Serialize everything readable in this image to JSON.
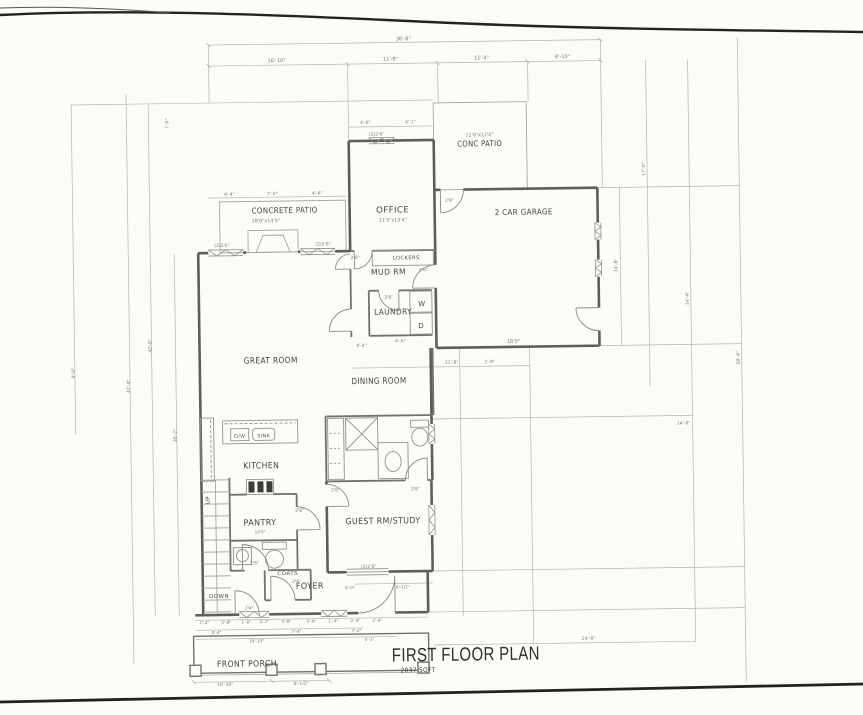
{
  "drawing": {
    "title": "FIRST FLOOR PLAN",
    "area": "2037 SQFT",
    "rooms": [
      "GREAT ROOM",
      "KITCHEN",
      "DINING ROOM",
      "OFFICE",
      "MUD RM",
      "LAUNDRY",
      "PANTRY",
      "FOYER",
      "GUEST RM/STUDY",
      "2 CAR GARAGE",
      "CONC PATIO",
      "CONCRETE PATIO",
      "FRONT PORCH"
    ]
  },
  "colors": {
    "paper": "#fcfbf8",
    "wall": "#5a5f59",
    "interior_wall": "#6e746c",
    "fixture_line": "#8d938b",
    "faint_line": "#b2b7ab",
    "room_text": "#42463e",
    "dim_text": "#757a6e",
    "scan_edge": "#23231d"
  },
  "labels": [
    {
      "id": "title-main",
      "text": "FIRST FLOOR PLAN",
      "x": 462,
      "y": 661,
      "fs": 19,
      "w": 148,
      "cls": "title"
    },
    {
      "id": "title-area",
      "text": "2037 SQFT",
      "x": 414,
      "y": 672,
      "fs": 6.5,
      "w": 35,
      "cls": "subtitle"
    },
    {
      "id": "room-conc-patio",
      "text": "CONC PATIO",
      "x": 483,
      "y": 147,
      "fs": 8,
      "w": 45
    },
    {
      "id": "dim-conc-patio",
      "text": "11'0\"x12'0\"",
      "x": 483,
      "y": 137,
      "fs": 4.8,
      "cls": "dim"
    },
    {
      "id": "room-garage",
      "text": "2 CAR GARAGE",
      "x": 526,
      "y": 216,
      "fs": 8,
      "w": 58
    },
    {
      "id": "room-office",
      "text": "OFFICE",
      "x": 395,
      "y": 212,
      "fs": 8.5,
      "w": 33
    },
    {
      "id": "dim-office",
      "text": "11'3\"x13'4\"",
      "x": 395,
      "y": 221,
      "fs": 4.8,
      "cls": "dim"
    },
    {
      "id": "room-concrete-patio",
      "text": "CONCRETE PATIO",
      "x": 287,
      "y": 211,
      "fs": 8,
      "w": 66
    },
    {
      "id": "dim-concrete-patio",
      "text": "18'0\"x14'0\"",
      "x": 268,
      "y": 220,
      "fs": 4.8,
      "cls": "dim"
    },
    {
      "id": "room-mud",
      "text": "MUD RM",
      "x": 390,
      "y": 274,
      "fs": 8,
      "w": 35
    },
    {
      "id": "fixture-lockers",
      "text": "LOCKERS",
      "x": 408,
      "y": 259,
      "fs": 5,
      "w": 27,
      "cls": "fix"
    },
    {
      "id": "room-laundry",
      "text": "LAUNDRY",
      "x": 394,
      "y": 314,
      "fs": 8,
      "w": 38
    },
    {
      "id": "fixture-washer",
      "text": "W",
      "x": 423,
      "y": 306,
      "fs": 7,
      "cls": "fix"
    },
    {
      "id": "fixture-dryer",
      "text": "D",
      "x": 422,
      "y": 328,
      "fs": 7,
      "cls": "fix"
    },
    {
      "id": "room-dining",
      "text": "DINING ROOM",
      "x": 379,
      "y": 383,
      "fs": 8.5,
      "w": 55
    },
    {
      "id": "room-great",
      "text": "GREAT ROOM",
      "x": 271,
      "y": 361,
      "fs": 8.5,
      "w": 54
    },
    {
      "id": "room-kitchen",
      "text": "KITCHEN",
      "x": 260,
      "y": 466,
      "fs": 8.5,
      "w": 36
    },
    {
      "id": "fixture-dw",
      "text": "D/W",
      "x": 239,
      "y": 435,
      "fs": 4.8,
      "cls": "fix"
    },
    {
      "id": "fixture-sink",
      "text": "SINK",
      "x": 263,
      "y": 435,
      "fs": 4.8,
      "cls": "fix"
    },
    {
      "id": "room-pantry",
      "text": "PANTRY",
      "x": 258,
      "y": 523,
      "fs": 8.5,
      "w": 33
    },
    {
      "id": "dim-pantry",
      "text": "14'0\"",
      "x": 258,
      "y": 531,
      "fs": 4.2,
      "cls": "dim"
    },
    {
      "id": "stairs-up",
      "text": "UP",
      "x": 208,
      "y": 497,
      "fs": 5.5,
      "rot": -90,
      "cls": "fix"
    },
    {
      "id": "stairs-down",
      "text": "DOWN",
      "x": 216,
      "y": 595,
      "fs": 5.5,
      "w": 20,
      "cls": "fix"
    },
    {
      "id": "room-guest",
      "text": "GUEST RM/STUDY",
      "x": 381,
      "y": 523,
      "fs": 8.5,
      "w": 75
    },
    {
      "id": "fixture-coats",
      "text": "COATS",
      "x": 285,
      "y": 573,
      "fs": 5,
      "w": 21,
      "cls": "fix"
    },
    {
      "id": "room-foyer",
      "text": "FOYER",
      "x": 307,
      "y": 587,
      "fs": 8.5,
      "w": 28
    },
    {
      "id": "room-porch",
      "text": "FRONT PORCH",
      "x": 243,
      "y": 664,
      "fs": 8.5,
      "w": 60
    },
    {
      "text": "38'-8\"",
      "x": 408,
      "y": 40,
      "fs": 5,
      "cls": "dim"
    },
    {
      "text": "16'-10\"",
      "x": 281,
      "y": 60,
      "fs": 5,
      "cls": "dim"
    },
    {
      "text": "11'-8\"",
      "x": 395,
      "y": 60,
      "fs": 5,
      "cls": "dim"
    },
    {
      "text": "11'-4\"",
      "x": 486,
      "y": 60,
      "fs": 5,
      "cls": "dim"
    },
    {
      "text": "8'-10\"",
      "x": 567,
      "y": 60,
      "fs": 5,
      "cls": "dim"
    },
    {
      "text": "4'-6\"",
      "x": 369,
      "y": 123,
      "fs": 4.5,
      "cls": "dim"
    },
    {
      "text": "4'-1\"",
      "x": 414,
      "y": 123,
      "fs": 4.5,
      "cls": "dim"
    },
    {
      "text": "(2)2'6\"",
      "x": 380,
      "y": 135,
      "fs": 4.5,
      "cls": "dim"
    },
    {
      "text": "4'-4\"",
      "x": 232,
      "y": 193,
      "fs": 4.5,
      "cls": "dim"
    },
    {
      "text": "7'-0\"",
      "x": 275,
      "y": 193,
      "fs": 4.5,
      "cls": "dim"
    },
    {
      "text": "4'-6\"",
      "x": 320,
      "y": 193,
      "fs": 4.5,
      "cls": "dim"
    },
    {
      "text": "(2)2'6\"",
      "x": 224,
      "y": 244,
      "fs": 4.5,
      "cls": "dim"
    },
    {
      "text": "(2)2'6\"",
      "x": 325,
      "y": 244,
      "fs": 4.5,
      "cls": "dim"
    },
    {
      "text": "2'8\"",
      "x": 357,
      "y": 258,
      "fs": 4.5,
      "cls": "dim"
    },
    {
      "text": "2'8\"",
      "x": 452,
      "y": 202,
      "fs": 4.5,
      "cls": "dim"
    },
    {
      "text": "2'6\"",
      "x": 425,
      "y": 271,
      "fs": 4.5,
      "cls": "dim"
    },
    {
      "text": "2'6\"",
      "x": 390,
      "y": 298,
      "fs": 4.5,
      "cls": "dim"
    },
    {
      "text": "4'-6\"",
      "x": 401,
      "y": 342,
      "fs": 4.5,
      "cls": "dim"
    },
    {
      "text": "4'-4\"",
      "x": 362,
      "y": 346,
      "fs": 4.5,
      "cls": "dim"
    },
    {
      "text": "11'-8\"",
      "x": 452,
      "y": 364,
      "fs": 4.5,
      "cls": "dim"
    },
    {
      "text": "1'-8\"",
      "x": 490,
      "y": 364,
      "fs": 4.5,
      "cls": "dim"
    },
    {
      "text": "18'0\"",
      "x": 514,
      "y": 344,
      "fs": 5,
      "cls": "dim"
    },
    {
      "text": "2'6\"",
      "x": 334,
      "y": 490,
      "fs": 4.5,
      "cls": "dim"
    },
    {
      "text": "2'6\"",
      "x": 414,
      "y": 490,
      "fs": 4.5,
      "cls": "dim"
    },
    {
      "text": "2'6\"",
      "x": 298,
      "y": 510,
      "fs": 4.5,
      "cls": "dim"
    },
    {
      "text": "2'6\"",
      "x": 252,
      "y": 562,
      "fs": 4.5,
      "cls": "dim"
    },
    {
      "text": "2'6\"",
      "x": 294,
      "y": 581,
      "fs": 4.5,
      "cls": "dim"
    },
    {
      "text": "(2)2'6\"",
      "x": 366,
      "y": 567,
      "fs": 4.5,
      "cls": "dim"
    },
    {
      "text": "8'-0\"",
      "x": 347,
      "y": 588,
      "fs": 4.2,
      "cls": "dim"
    },
    {
      "text": "4'-1/2\"",
      "x": 400,
      "y": 588,
      "fs": 4.2,
      "cls": "dim"
    },
    {
      "text": "2'4\"",
      "x": 246,
      "y": 607,
      "fs": 4.2,
      "cls": "dim"
    },
    {
      "text": "7'-4\"",
      "x": 201,
      "y": 621,
      "fs": 4.2,
      "cls": "dim"
    },
    {
      "text": "5'-8\"",
      "x": 223,
      "y": 621,
      "fs": 4.2,
      "cls": "dim"
    },
    {
      "text": "1'-8\"",
      "x": 243,
      "y": 621,
      "fs": 4.2,
      "cls": "dim"
    },
    {
      "text": "3'-7\"",
      "x": 261,
      "y": 621,
      "fs": 4.2,
      "cls": "dim"
    },
    {
      "text": "3'-8\"",
      "x": 283,
      "y": 621,
      "fs": 4.2,
      "cls": "dim"
    },
    {
      "text": "3'-4\"",
      "x": 308,
      "y": 621,
      "fs": 4.2,
      "cls": "dim"
    },
    {
      "text": "1'-4\"",
      "x": 330,
      "y": 621,
      "fs": 4.2,
      "cls": "dim"
    },
    {
      "text": "3'-4\"",
      "x": 352,
      "y": 621,
      "fs": 4.2,
      "cls": "dim"
    },
    {
      "text": "2'-8\"",
      "x": 374,
      "y": 621,
      "fs": 4.2,
      "cls": "dim"
    },
    {
      "text": "8'-4\"",
      "x": 213,
      "y": 631,
      "fs": 4.2,
      "cls": "dim"
    },
    {
      "text": "7'-4\"",
      "x": 293,
      "y": 631,
      "fs": 4.2,
      "cls": "dim"
    },
    {
      "text": "7'-2\"",
      "x": 353,
      "y": 631,
      "fs": 4.2,
      "cls": "dim"
    },
    {
      "text": "19'-10\"",
      "x": 253,
      "y": 640,
      "fs": 4.2,
      "cls": "dim"
    },
    {
      "text": "5'-1\"",
      "x": 366,
      "y": 640,
      "fs": 4.2,
      "cls": "dim"
    },
    {
      "text": "10'-10\"",
      "x": 221,
      "y": 683,
      "fs": 4.5,
      "cls": "dim"
    },
    {
      "text": "8'-1/2\"",
      "x": 297,
      "y": 683,
      "fs": 4.5,
      "cls": "dim"
    },
    {
      "text": "9'-0\"",
      "x": 75,
      "y": 368,
      "fs": 4.5,
      "rot": -90,
      "cls": "dim"
    },
    {
      "text": "47'-4\"",
      "x": 130,
      "y": 382,
      "fs": 4.5,
      "rot": -90,
      "cls": "dim"
    },
    {
      "text": "42'-8\"",
      "x": 152,
      "y": 342,
      "fs": 4.5,
      "rot": -90,
      "cls": "dim"
    },
    {
      "text": "30'-2\"",
      "x": 176,
      "y": 432,
      "fs": 4.5,
      "rot": -90,
      "cls": "dim"
    },
    {
      "text": "7'-0\"",
      "x": 172,
      "y": 120,
      "fs": 4.5,
      "rot": -90,
      "cls": "dim"
    },
    {
      "text": "14'-8\"",
      "x": 619,
      "y": 268,
      "fs": 4.5,
      "rot": -90,
      "cls": "dim"
    },
    {
      "text": "17'-0\"",
      "x": 648,
      "y": 172,
      "fs": 4.5,
      "rot": -90,
      "cls": "dim"
    },
    {
      "text": "34'-4\"",
      "x": 690,
      "y": 302,
      "fs": 4.5,
      "rot": -90,
      "cls": "dim"
    },
    {
      "text": "58'-4\"",
      "x": 740,
      "y": 362,
      "fs": 4.5,
      "rot": -90,
      "cls": "dim"
    },
    {
      "text": "14'-0\"",
      "x": 683,
      "y": 428,
      "fs": 4.5,
      "cls": "dim"
    },
    {
      "text": "24'-8\"",
      "x": 585,
      "y": 642,
      "fs": 4.5,
      "cls": "dim"
    }
  ]
}
